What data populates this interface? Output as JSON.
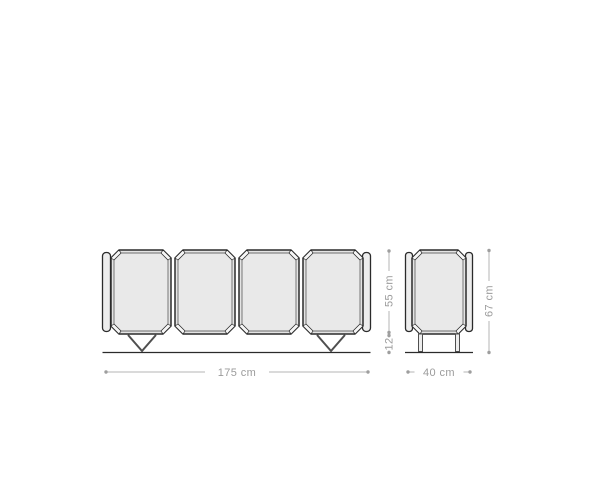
{
  "diagram": {
    "product": "sideboard",
    "views": {
      "front": {
        "door_count": 4,
        "dimensions": {
          "width": "175 cm",
          "body_height": "55 cm",
          "leg_height": "12"
        }
      },
      "side": {
        "dimensions": {
          "depth": "40 cm",
          "total_height": "67 cm"
        }
      }
    }
  },
  "colors": {
    "background": "#ffffff",
    "outline": "#2b2b2b",
    "panel_fill": "#e4e4e4",
    "panel_inner": "#e9e9e9",
    "corner_wedge": "#f7f7f7",
    "strip_fill": "#ededed",
    "leg_stroke": "#4f4f4f",
    "dim_line": "#b5b5b5",
    "dim_dot": "#9e9e9e",
    "dim_text": "#9b9b9b"
  }
}
